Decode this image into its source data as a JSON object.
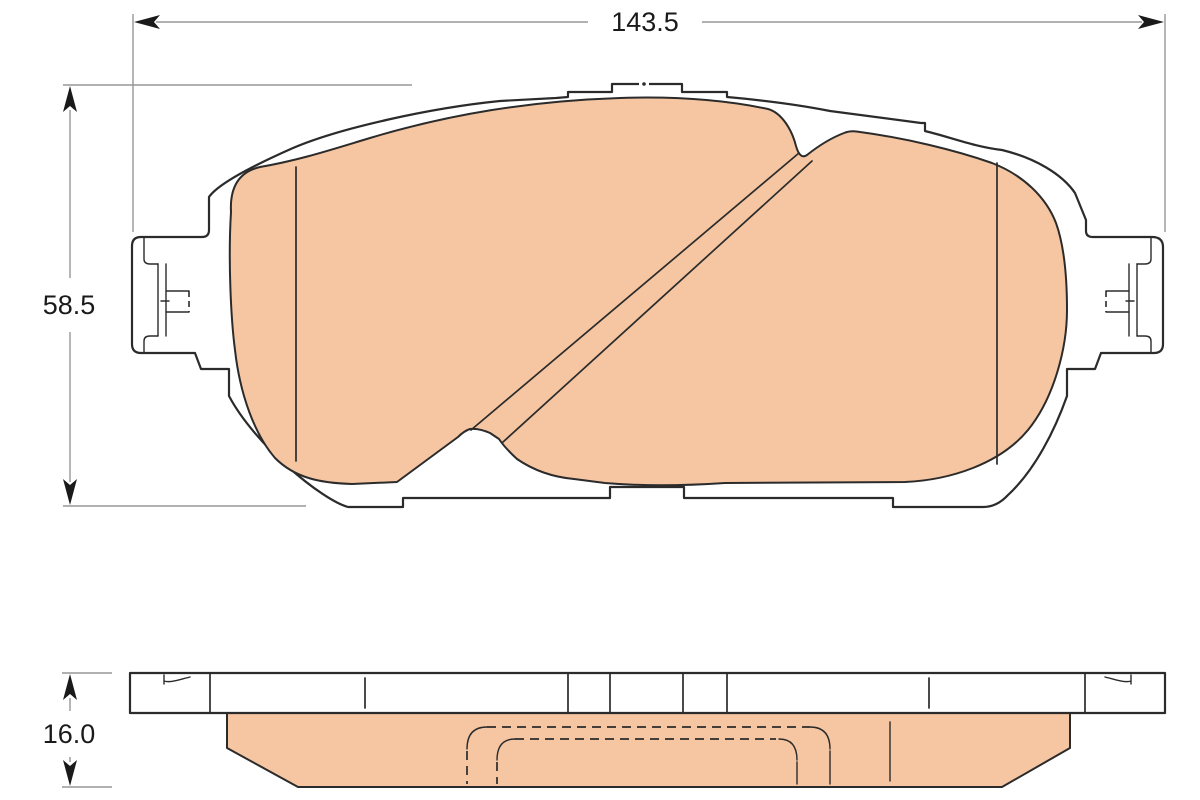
{
  "drawing": {
    "kind": "technical-drawing",
    "views": {
      "front": "brake-pad-front-view",
      "side": "brake-pad-side-view"
    },
    "dimensions": {
      "width": {
        "label": "143.5",
        "orientation": "horizontal"
      },
      "height": {
        "label": "58.5",
        "orientation": "vertical"
      },
      "thickness": {
        "label": "16.0",
        "orientation": "vertical"
      }
    },
    "colors": {
      "friction_material": "#f6c6a2",
      "outline": "#2b2b2b",
      "dimension_line": "#979797",
      "arrowhead": "#1a1a1a",
      "text": "#1a1a1a",
      "background": "#ffffff"
    }
  }
}
